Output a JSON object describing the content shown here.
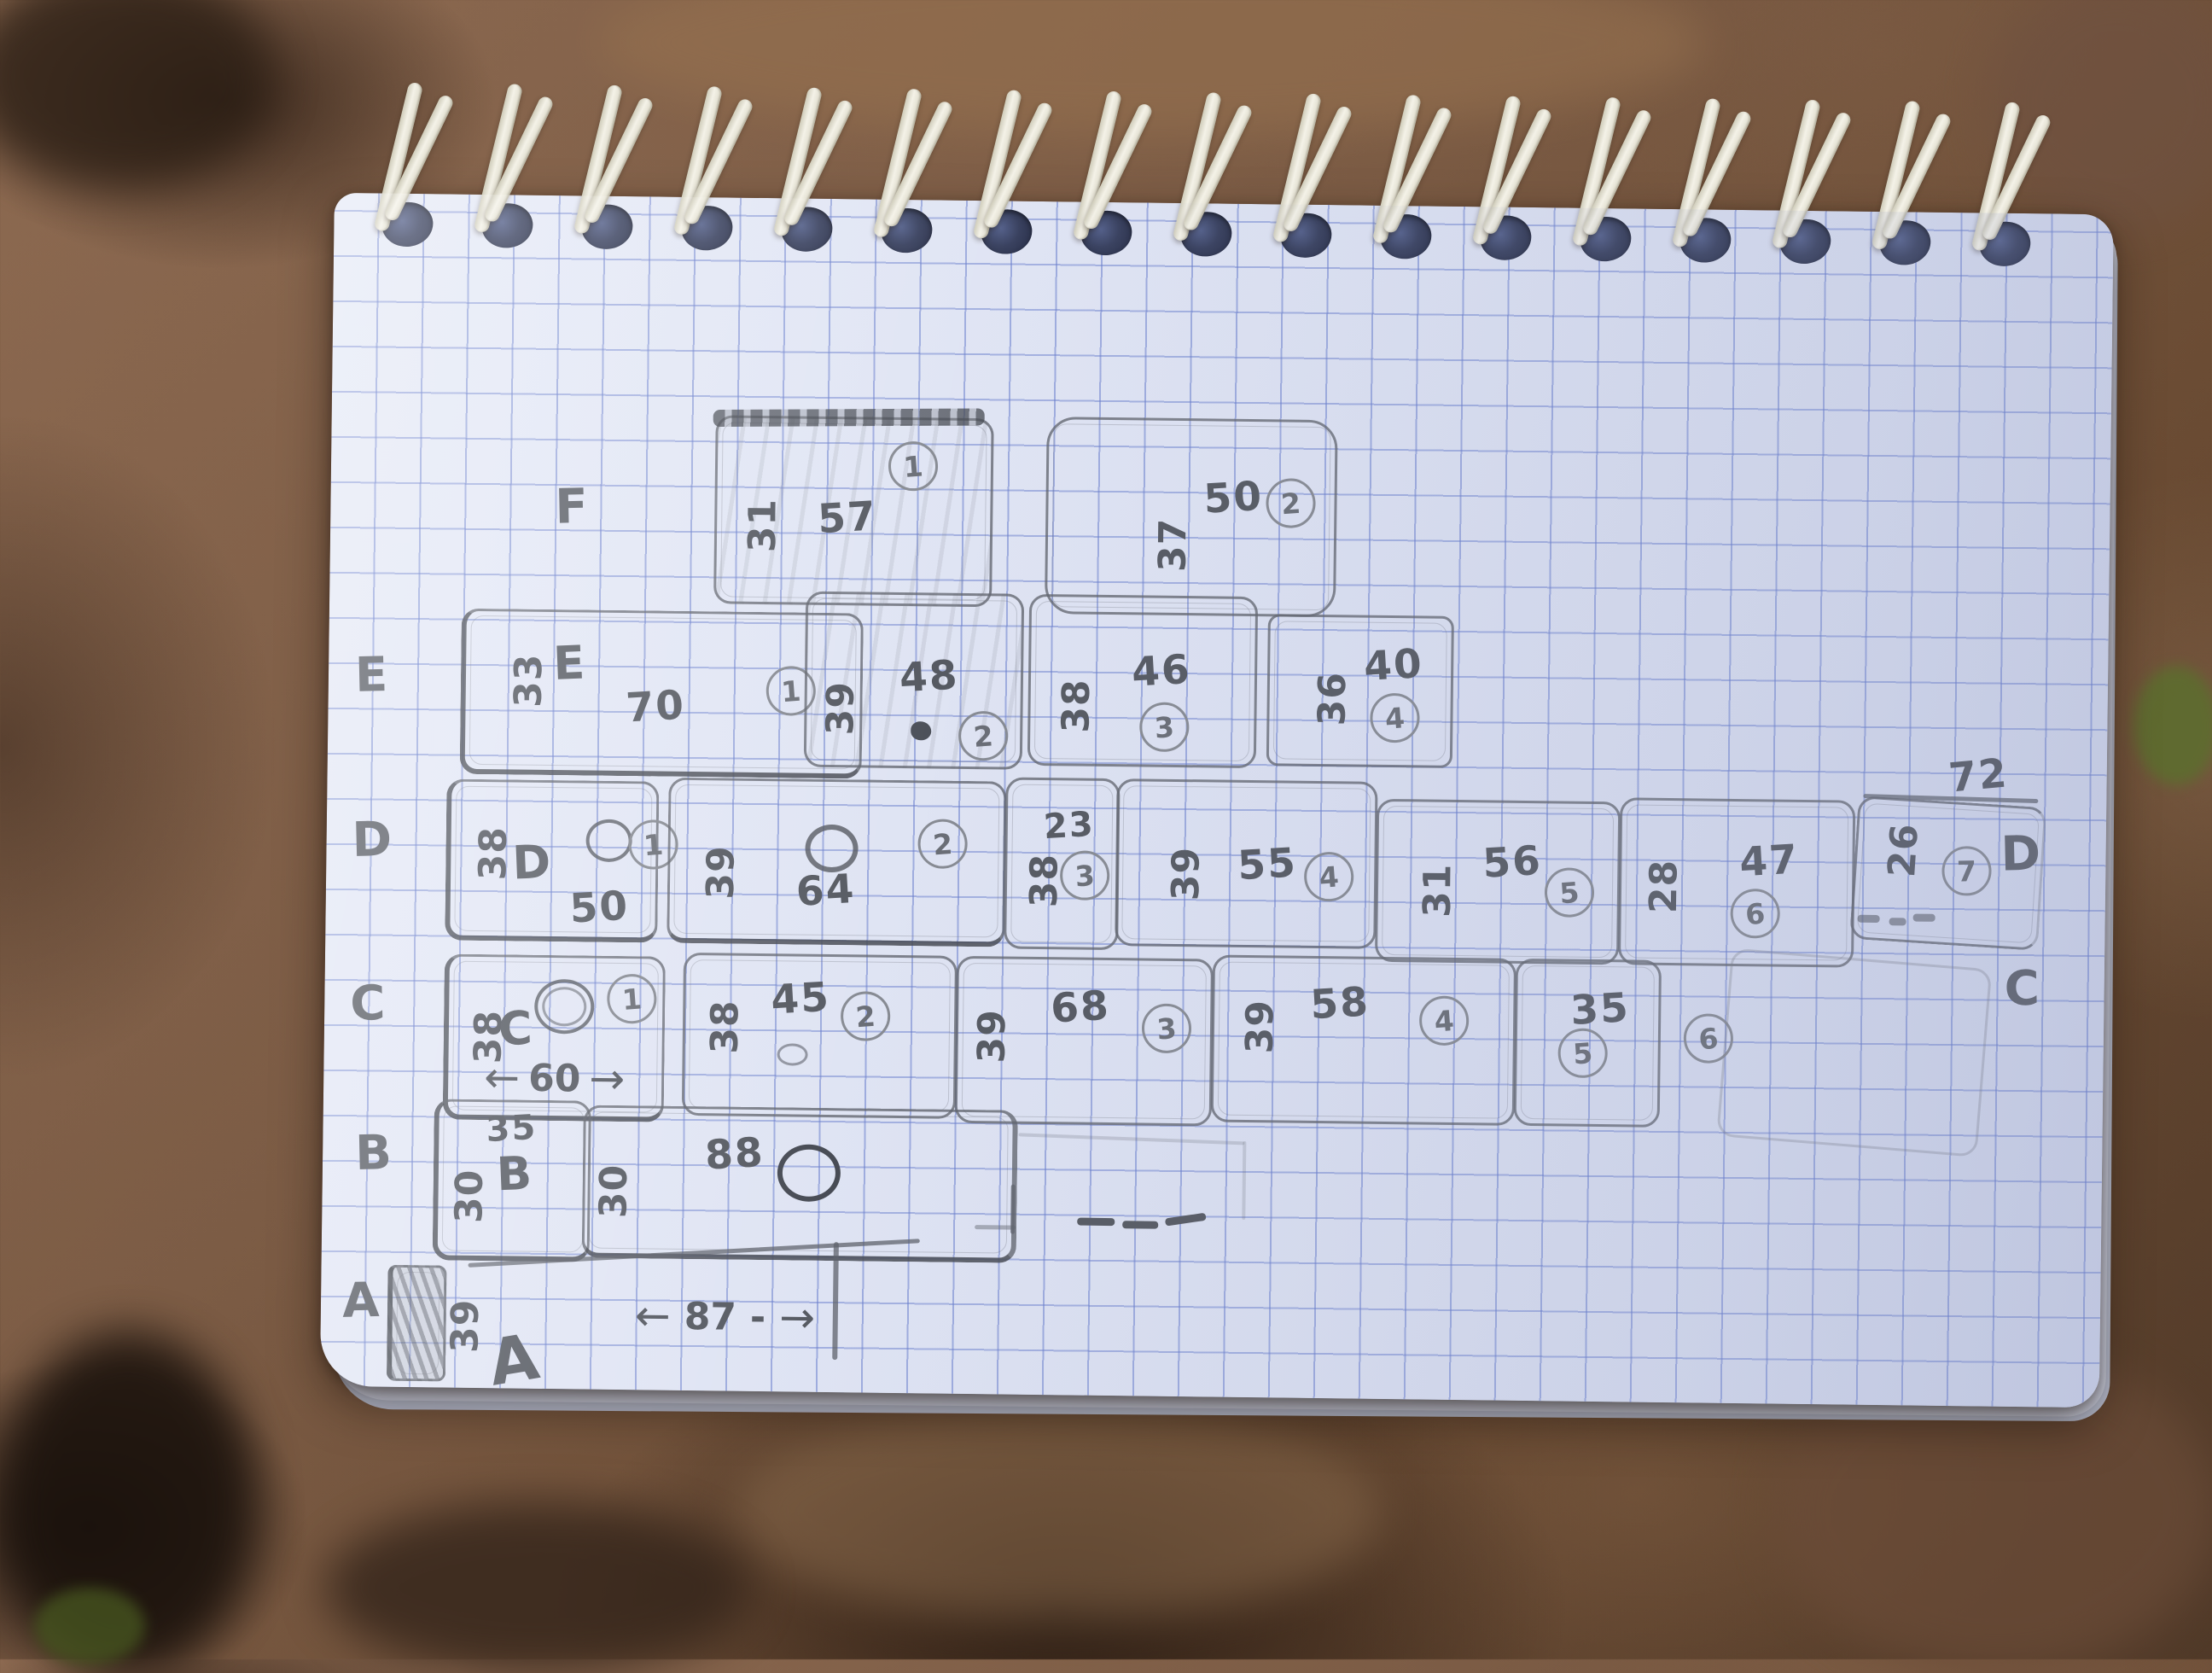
{
  "labels": {
    "f": "F",
    "e": "E",
    "d": "D",
    "c": "C",
    "b": "B",
    "a": "A",
    "d_right": "D",
    "c_right": "C",
    "a_big": "A"
  },
  "dims": {
    "top_right": "72",
    "row_a": "87",
    "row_c1": "60",
    "arrow_left": "←",
    "arrow_right": "→",
    "dash": "-"
  },
  "stones": {
    "f1": {
      "side": "31",
      "main": "57",
      "seq": "1"
    },
    "f2": {
      "side": "37",
      "main": "50",
      "seq": "2"
    },
    "e1": {
      "side": "33",
      "label": "E",
      "main": "70",
      "seq": "1"
    },
    "e2": {
      "side": "39",
      "main": "48",
      "seq": "2"
    },
    "e3": {
      "side": "38",
      "main": "46",
      "seq": "3"
    },
    "e4": {
      "side": "36",
      "main": "40",
      "seq": "4"
    },
    "d1": {
      "side": "38",
      "label": "D",
      "main": "50",
      "seq": "1"
    },
    "d2": {
      "side": "39",
      "main": "64",
      "seq": "2"
    },
    "d3": {
      "side": "38",
      "top": "23",
      "seq": "3"
    },
    "d4": {
      "side": "39",
      "main": "55",
      "seq": "4"
    },
    "d5": {
      "side": "31",
      "main": "56",
      "seq": "5"
    },
    "d6": {
      "side": "28",
      "main": "47",
      "seq": "6"
    },
    "d7": {
      "side": "26",
      "seq": "7"
    },
    "c1": {
      "side": "38",
      "label": "C",
      "seq": "1",
      "dim": "60"
    },
    "c2": {
      "side": "38",
      "main": "45",
      "seq": "2"
    },
    "c3": {
      "side": "39",
      "main": "68",
      "seq": "3"
    },
    "c4": {
      "side": "39",
      "main": "58",
      "seq": "4"
    },
    "c5": {
      "main": "35",
      "seq": "5"
    },
    "c6": {
      "seq": "6"
    },
    "b1": {
      "top": "35",
      "label": "B",
      "side": "30"
    },
    "b2": {
      "side": "30",
      "main": "88"
    },
    "a1": {
      "side": "39",
      "dim": "87"
    }
  },
  "notebook": {
    "coil_count": 17
  }
}
